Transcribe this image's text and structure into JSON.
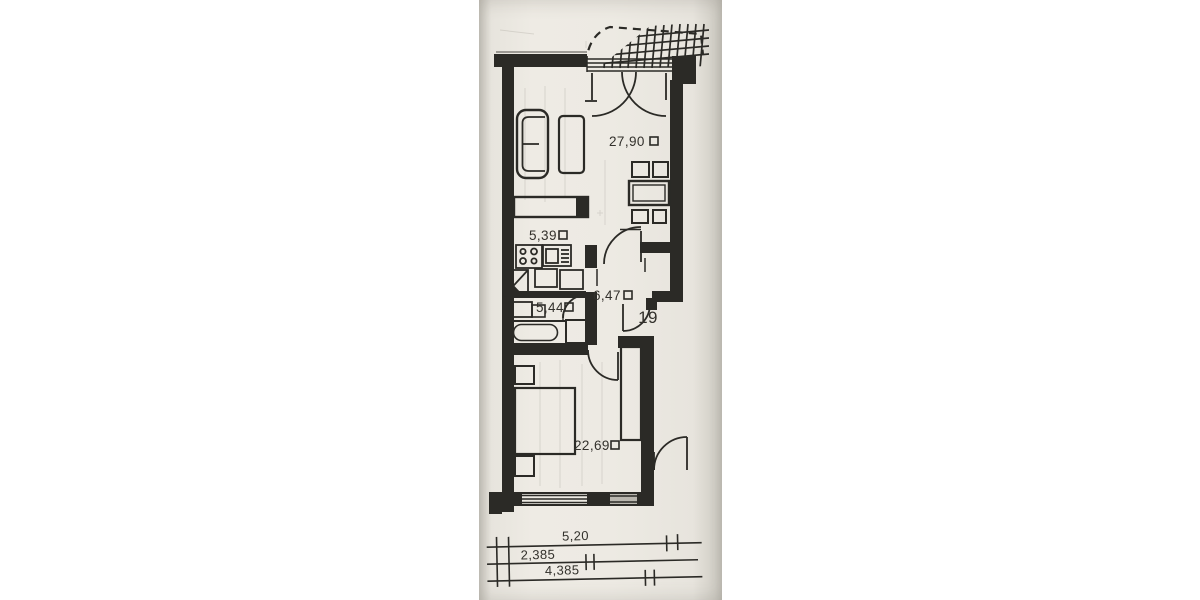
{
  "plan": {
    "document_type": "scanned apartment floor plan",
    "apartment_number": "19",
    "unit_symbol_name": "square-meter-box",
    "rooms": {
      "living": {
        "area": "27,90"
      },
      "kitchen": {
        "area": "5,39"
      },
      "hall": {
        "area": "6,47"
      },
      "bath": {
        "area": "5,44"
      },
      "bedroom": {
        "area": "22,69"
      }
    },
    "dimensions": {
      "overall": "5,20",
      "partial_a": "2,385",
      "partial_b": "4,385"
    },
    "colors": {
      "paper": "#edeae3",
      "ink": "#2b2a26"
    }
  }
}
